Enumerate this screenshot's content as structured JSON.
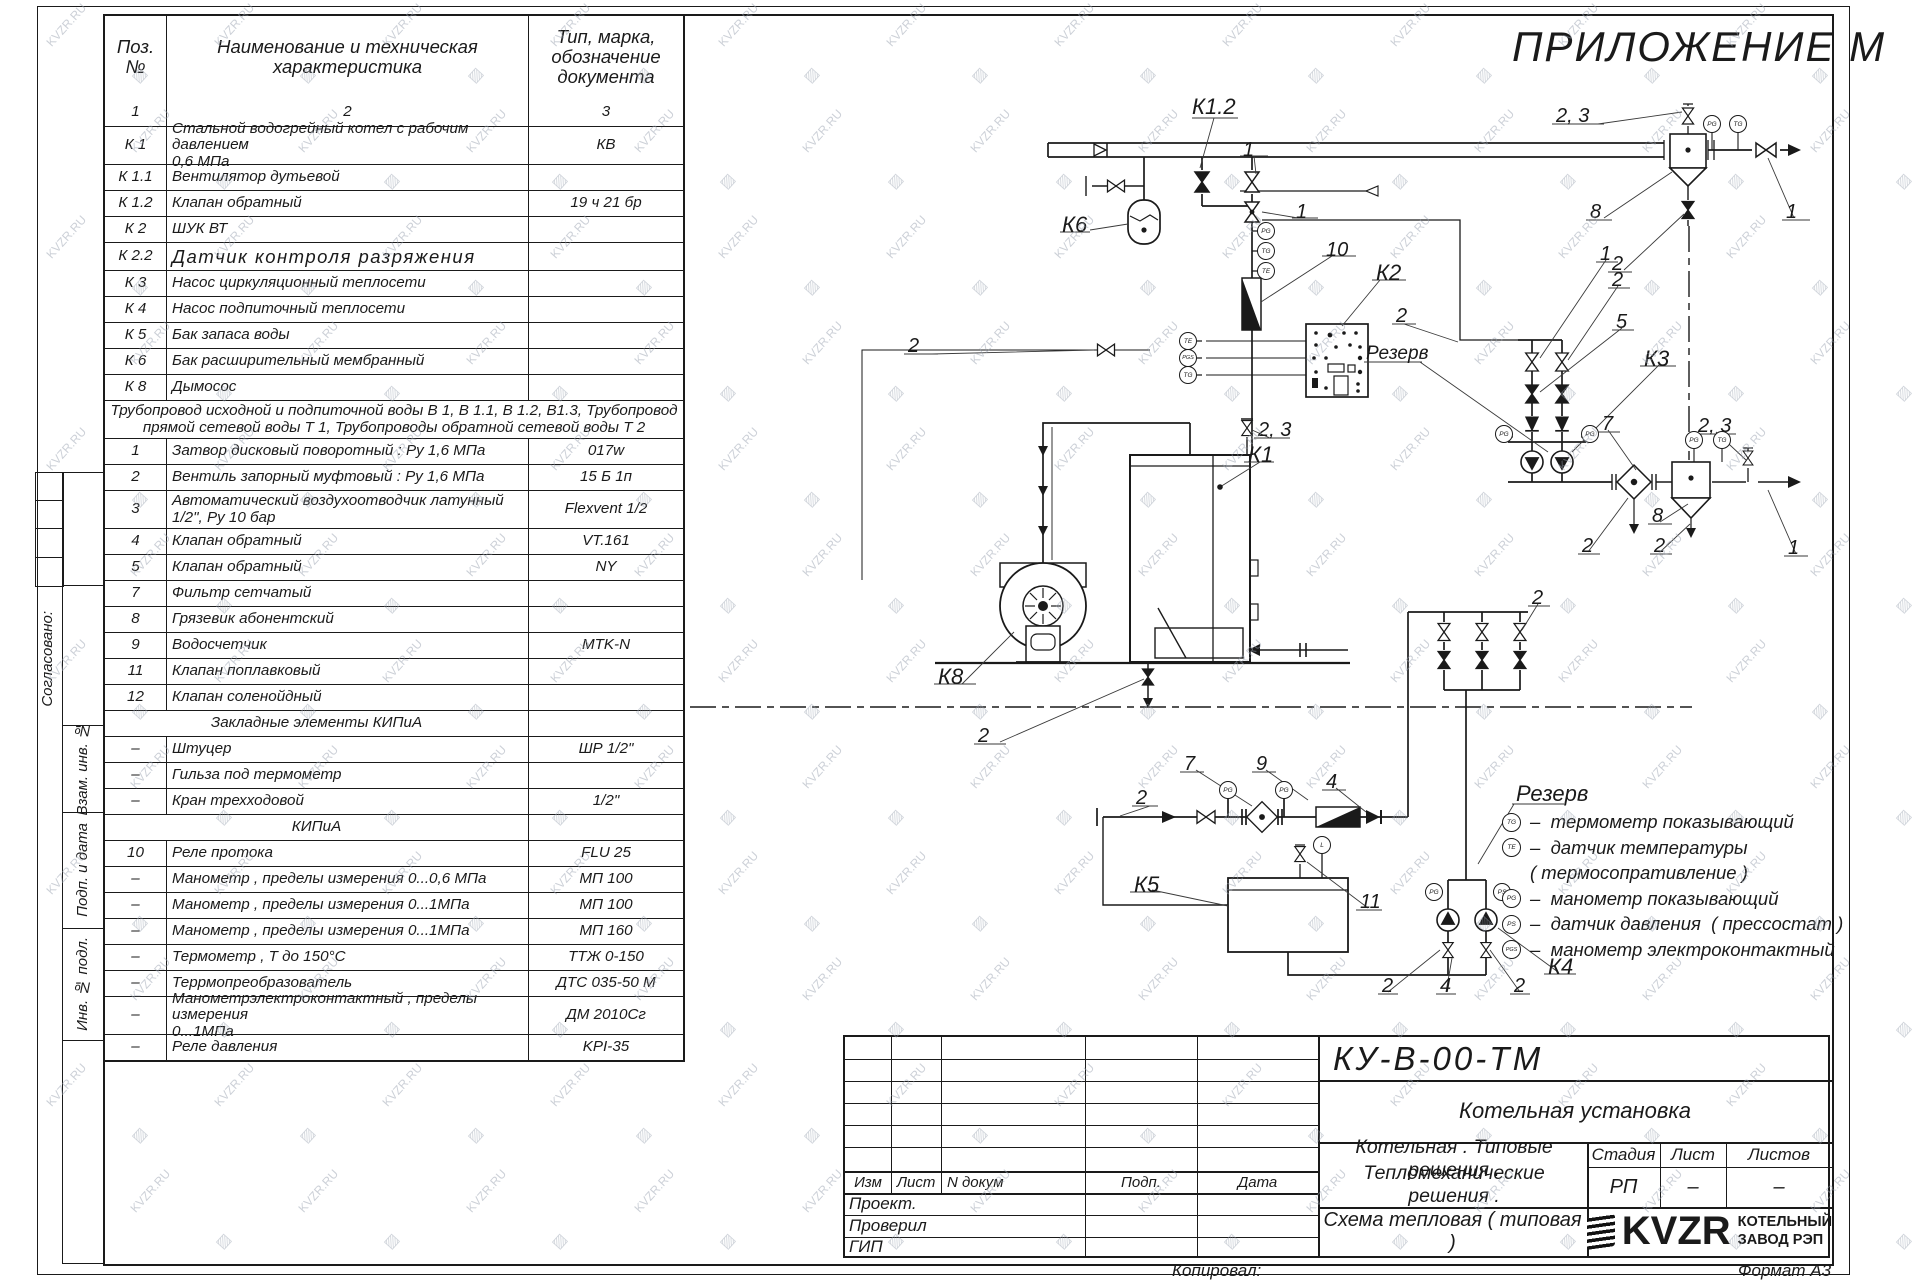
{
  "sheet": {
    "appendix_title": "ПРИЛОЖЕНИЕ М",
    "copied_label": "Копировал:",
    "format_label": "Формат А3"
  },
  "watermark": {
    "text": "KVZR.RU",
    "glyph": "▨"
  },
  "side_strip": {
    "labels": [
      "Согласовано:",
      "Взам. инв. №",
      "Подп. и дата",
      "Инв. № подл."
    ]
  },
  "spec_table": {
    "headers": {
      "pos": "Поз.\n№",
      "name": "Наименование и техническая\nхарактеристика",
      "type": "Тип, марка,\nобозначение\nдокумента"
    },
    "rows": [
      {
        "k": "cols",
        "p": "1",
        "n": "2",
        "t": "3",
        "c": 1,
        "h": 28
      },
      {
        "k": "cols",
        "p": "К 1",
        "n": "Стальной водогрейный котел с рабочим давлением\n0,6  МПа",
        "t": "КВ",
        "h": 38
      },
      {
        "k": "cols",
        "p": "К 1.1",
        "n": "Вентилятор дутьевой",
        "t": "",
        "h": 26
      },
      {
        "k": "cols",
        "p": "К 1.2",
        "n": "Клапан обратный",
        "t": "19 ч 21 бр",
        "h": 26
      },
      {
        "k": "cols",
        "p": "К 2",
        "n": "ШУК ВТ",
        "t": "",
        "h": 26
      },
      {
        "k": "cols",
        "p": "К 2.2",
        "n": "Датчик контроля разряжения",
        "t": "",
        "h": 28,
        "cls": "big"
      },
      {
        "k": "cols",
        "p": "К 3",
        "n": "Насос циркуляционный теплосети",
        "t": "",
        "h": 26
      },
      {
        "k": "cols",
        "p": "К 4",
        "n": "Насос подпиточный теплосети",
        "t": "",
        "h": 26
      },
      {
        "k": "cols",
        "p": "К 5",
        "n": "Бак запаса воды",
        "t": "",
        "h": 26
      },
      {
        "k": "cols",
        "p": "К 6",
        "n": "Бак расширительный мембранный",
        "t": "",
        "h": 26
      },
      {
        "k": "cols",
        "p": "К 8",
        "n": "Дымосос",
        "t": "",
        "h": 26
      },
      {
        "k": "span",
        "n": "Трубопровод исходной и подпиточной воды В 1,    В 1.1,    В 1.2, В1.3,   Трубопровод\nпрямой сетевой воды Т 1,   Трубопроводы обратной сетевой воды Т 2",
        "h": 38
      },
      {
        "k": "cols",
        "p": "1",
        "n": "Затвор дисковый поворотный :  Ру 1,6  МПа",
        "t": "017w",
        "h": 26
      },
      {
        "k": "cols",
        "p": "2",
        "n": "Вентиль запорный муфтовый :  Ру 1,6  МПа",
        "t": "15 Б 1п",
        "h": 26
      },
      {
        "k": "cols",
        "p": "3",
        "n": "Автоматический воздухоотводчик   латунный\n1/2\",  Ру  10  бар",
        "t": "Flexvent  1/2",
        "h": 38
      },
      {
        "k": "cols",
        "p": "4",
        "n": "Клапан обратный",
        "t": "VT.161",
        "h": 26
      },
      {
        "k": "cols",
        "p": "5",
        "n": "Клапан обратный",
        "t": "NY",
        "h": 26
      },
      {
        "k": "cols",
        "p": "7",
        "n": "Фильтр сетчатый",
        "t": "",
        "h": 26
      },
      {
        "k": "cols",
        "p": "8",
        "n": "Грязевик абонентский",
        "t": "",
        "h": 26
      },
      {
        "k": "cols",
        "p": "9",
        "n": "Водосчетчик",
        "t": "MTK-N",
        "h": 26
      },
      {
        "k": "cols",
        "p": "11",
        "n": "Клапан поплавковый",
        "t": "",
        "h": 26
      },
      {
        "k": "cols",
        "p": "12",
        "n": "Клапан соленойдный",
        "t": "",
        "h": 26
      },
      {
        "k": "section",
        "n": "Закладные элементы КИПиА",
        "h": 26
      },
      {
        "k": "cols",
        "p": "–",
        "n": "Штуцер",
        "t": "ШР  1/2\"",
        "h": 26
      },
      {
        "k": "cols",
        "p": "–",
        "n": "Гильза под термометр",
        "t": "",
        "h": 26
      },
      {
        "k": "cols",
        "p": "–",
        "n": "Кран трехходовой",
        "t": "1/2\"",
        "h": 26
      },
      {
        "k": "section",
        "n": "КИПиА",
        "h": 26
      },
      {
        "k": "cols",
        "p": "10",
        "n": "Реле протока",
        "t": "FLU 25",
        "h": 26
      },
      {
        "k": "cols",
        "p": "–",
        "n": "Манометр ,  пределы измерения   0...0,6 МПа",
        "t": "МП 100",
        "h": 26
      },
      {
        "k": "cols",
        "p": "–",
        "n": "Манометр ,  пределы измерения   0...1МПа",
        "t": "МП 100",
        "h": 26
      },
      {
        "k": "cols",
        "p": "–",
        "n": "Манометр ,  пределы измерения   0...1МПа",
        "t": "МП 160",
        "h": 26
      },
      {
        "k": "cols",
        "p": "–",
        "n": "Термометр ,  Т  до  150°С",
        "t": "ТТЖ  0-150",
        "h": 26
      },
      {
        "k": "cols",
        "p": "–",
        "n": "Террмопреобразователь",
        "t": "ДТС 035-50 М",
        "h": 26
      },
      {
        "k": "cols",
        "p": "–",
        "n": "Манометрэлектроконтактный ,  пределы измерения\n0...1МПа",
        "t": "ДМ 2010Сг",
        "h": 38
      },
      {
        "k": "cols",
        "p": "–",
        "n": "Реле давления",
        "t": "KPI-35",
        "h": 26
      }
    ]
  },
  "schematic": {
    "labels": [
      {
        "t": "К1.2",
        "x": 1192,
        "y": 96,
        "fs": 22
      },
      {
        "t": "1",
        "x": 1243,
        "y": 140
      },
      {
        "t": "К6",
        "x": 1062,
        "y": 214,
        "fs": 22
      },
      {
        "t": "1",
        "x": 1296,
        "y": 202
      },
      {
        "t": "10",
        "x": 1326,
        "y": 240
      },
      {
        "t": "К2",
        "x": 1376,
        "y": 262,
        "fs": 22
      },
      {
        "t": "2",
        "x": 1396,
        "y": 306
      },
      {
        "t": "Резерв",
        "x": 1366,
        "y": 344,
        "fs": 19
      },
      {
        "t": "2",
        "x": 908,
        "y": 336
      },
      {
        "t": "2, 3",
        "x": 1258,
        "y": 420
      },
      {
        "t": "К1",
        "x": 1248,
        "y": 444,
        "fs": 22
      },
      {
        "t": "К8",
        "x": 938,
        "y": 666,
        "fs": 22
      },
      {
        "t": "2",
        "x": 978,
        "y": 726
      },
      {
        "t": "2, 3",
        "x": 1556,
        "y": 106
      },
      {
        "t": "8",
        "x": 1590,
        "y": 202
      },
      {
        "t": "2",
        "x": 1612,
        "y": 254
      },
      {
        "t": "1",
        "x": 1786,
        "y": 202
      },
      {
        "t": "1",
        "x": 1600,
        "y": 244
      },
      {
        "t": "2",
        "x": 1612,
        "y": 270
      },
      {
        "t": "5",
        "x": 1616,
        "y": 312
      },
      {
        "t": "К3",
        "x": 1644,
        "y": 348,
        "fs": 22
      },
      {
        "t": "7",
        "x": 1602,
        "y": 414
      },
      {
        "t": "2, 3",
        "x": 1698,
        "y": 416
      },
      {
        "t": "8",
        "x": 1652,
        "y": 506
      },
      {
        "t": "2",
        "x": 1582,
        "y": 536
      },
      {
        "t": "2",
        "x": 1654,
        "y": 536
      },
      {
        "t": "1",
        "x": 1788,
        "y": 538
      },
      {
        "t": "2",
        "x": 1532,
        "y": 588
      },
      {
        "t": "2",
        "x": 1136,
        "y": 788
      },
      {
        "t": "7",
        "x": 1184,
        "y": 754
      },
      {
        "t": "9",
        "x": 1256,
        "y": 754
      },
      {
        "t": "4",
        "x": 1326,
        "y": 772
      },
      {
        "t": "К5",
        "x": 1134,
        "y": 874,
        "fs": 22
      },
      {
        "t": "11",
        "x": 1360,
        "y": 892
      },
      {
        "t": "2",
        "x": 1382,
        "y": 976
      },
      {
        "t": "4",
        "x": 1440,
        "y": 976
      },
      {
        "t": "2",
        "x": 1514,
        "y": 976
      },
      {
        "t": "К4",
        "x": 1548,
        "y": 956,
        "fs": 22
      }
    ],
    "sensors": [
      {
        "t": "PG",
        "x": 1266,
        "y": 231
      },
      {
        "t": "TG",
        "x": 1266,
        "y": 251
      },
      {
        "t": "TE",
        "x": 1266,
        "y": 271
      },
      {
        "t": "TE",
        "x": 1188,
        "y": 341
      },
      {
        "t": "PGS",
        "x": 1188,
        "y": 358
      },
      {
        "t": "TG",
        "x": 1188,
        "y": 375
      },
      {
        "t": "PG",
        "x": 1712,
        "y": 124
      },
      {
        "t": "TG",
        "x": 1738,
        "y": 124
      },
      {
        "t": "PG",
        "x": 1504,
        "y": 434
      },
      {
        "t": "PG",
        "x": 1590,
        "y": 434
      },
      {
        "t": "PG",
        "x": 1694,
        "y": 440
      },
      {
        "t": "TG",
        "x": 1722,
        "y": 440
      },
      {
        "t": "PG",
        "x": 1228,
        "y": 790
      },
      {
        "t": "PG",
        "x": 1284,
        "y": 790
      },
      {
        "t": "PG",
        "x": 1434,
        "y": 892
      },
      {
        "t": "PS",
        "x": 1502,
        "y": 892
      },
      {
        "t": "L",
        "x": 1322,
        "y": 845
      }
    ]
  },
  "legend": {
    "title": "Резерв",
    "items": [
      {
        "s": "TG",
        "t": "–  термометр показывающий"
      },
      {
        "s": "TE",
        "t": "–  датчик температуры"
      },
      {
        "s": "",
        "t": "( термосопративление )"
      },
      {
        "s": "PG",
        "t": "–  манометр показывающий"
      },
      {
        "s": "PS",
        "t": "–  датчик давления  ( прессостат )"
      },
      {
        "s": "PGS",
        "t": "–  манометр электроконтактный"
      }
    ]
  },
  "title_block": {
    "doc_code": "КУ-В-00-ТМ",
    "object_name": "Котельная установка",
    "rev_headers": [
      "Изм",
      "Лист",
      "N докум",
      "Подп.",
      "Дата"
    ],
    "roles": [
      "Проект.",
      "Проверил",
      "ГИП"
    ],
    "project_line1": "Котельная . Типовые решения .",
    "project_line2": "Тепломеханические решения .",
    "stage_headers": [
      "Стадия",
      "Лист",
      "Листов"
    ],
    "stage_values": [
      "РП",
      "–",
      "–"
    ],
    "scheme_name": "Схема тепловая  ( типовая )",
    "logo_text": "KVZR",
    "company_line1": "КОТЕЛЬНЫЙ",
    "company_line2": "ЗАВОД РЭП"
  }
}
